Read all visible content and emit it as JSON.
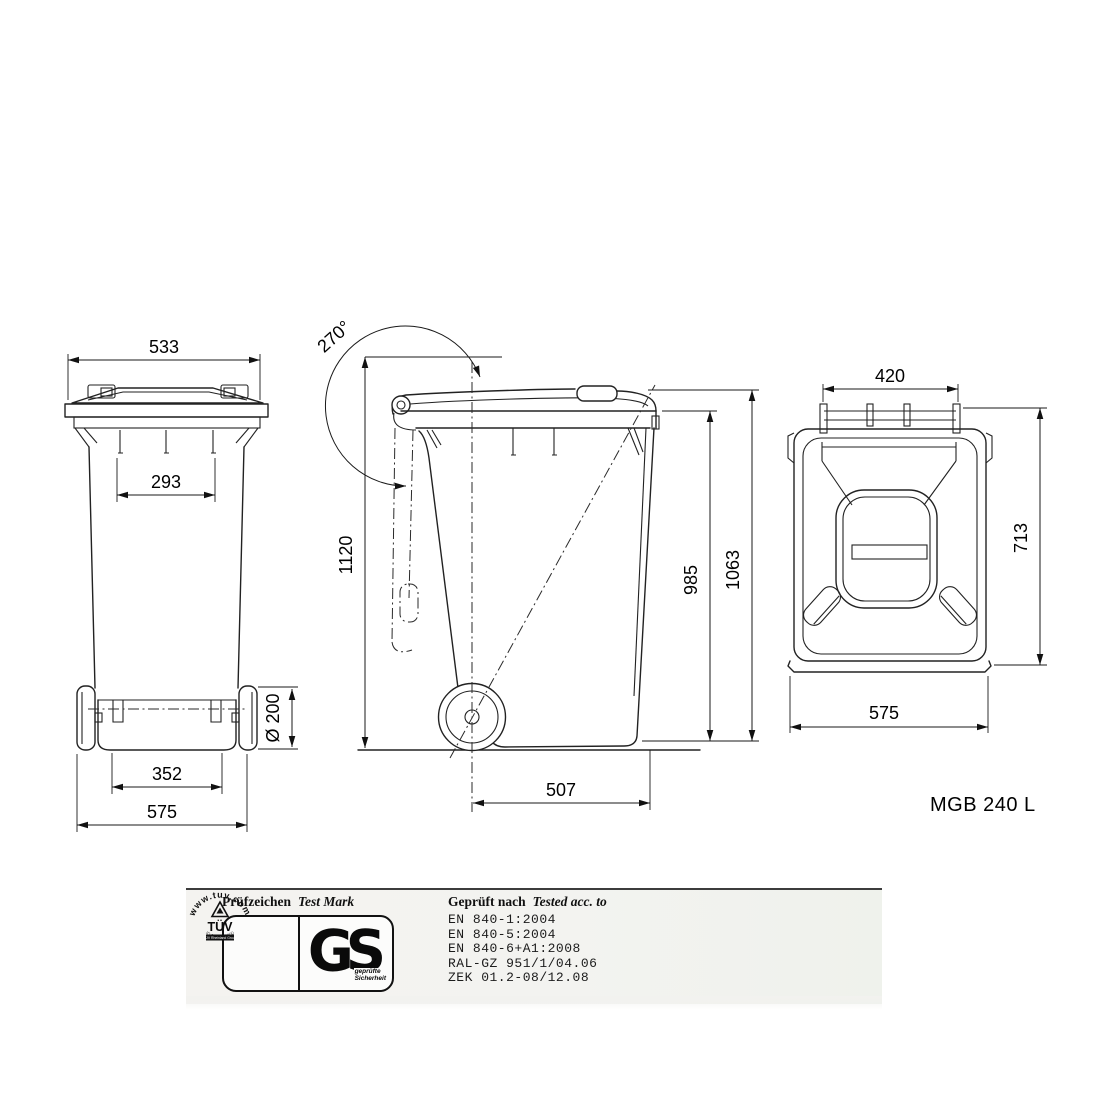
{
  "product_label": "MGB 240 L",
  "dimensions": {
    "front": {
      "top_width": "533",
      "inner_width": "293",
      "wheel_diameter": "Ø 200",
      "wheel_track": "352",
      "overall_width": "575"
    },
    "side": {
      "lid_open_angle": "270°",
      "open_height": "1120",
      "rim_height": "985",
      "overall_height": "1063",
      "axle_to_front": "507"
    },
    "top": {
      "handle_width": "420",
      "depth": "713",
      "overall_width": "575"
    }
  },
  "certification": {
    "left_header_de": "Prüfzeichen",
    "left_header_en": "Test Mark",
    "right_header_de": "Geprüft nach",
    "right_header_en": "Tested acc. to",
    "standards": [
      "EN 840-1:2004",
      "EN 840-5:2004",
      "EN 840-6+A1:2008",
      "RAL-GZ 951/1/04.06",
      "ZEK 01.2-08/12.08"
    ],
    "tuv": {
      "arc_text": "www.tuv.com",
      "name": "TÜV",
      "sub_text": "TÜV Rheinland Group",
      "id_text": "ID 1000000000"
    },
    "gs": {
      "letters": "GS",
      "caption_line1": "geprüfte",
      "caption_line2": "Sicherheit"
    }
  },
  "colors": {
    "line": "#222222",
    "background": "#ffffff",
    "strip_background": "#f3f3f0"
  }
}
